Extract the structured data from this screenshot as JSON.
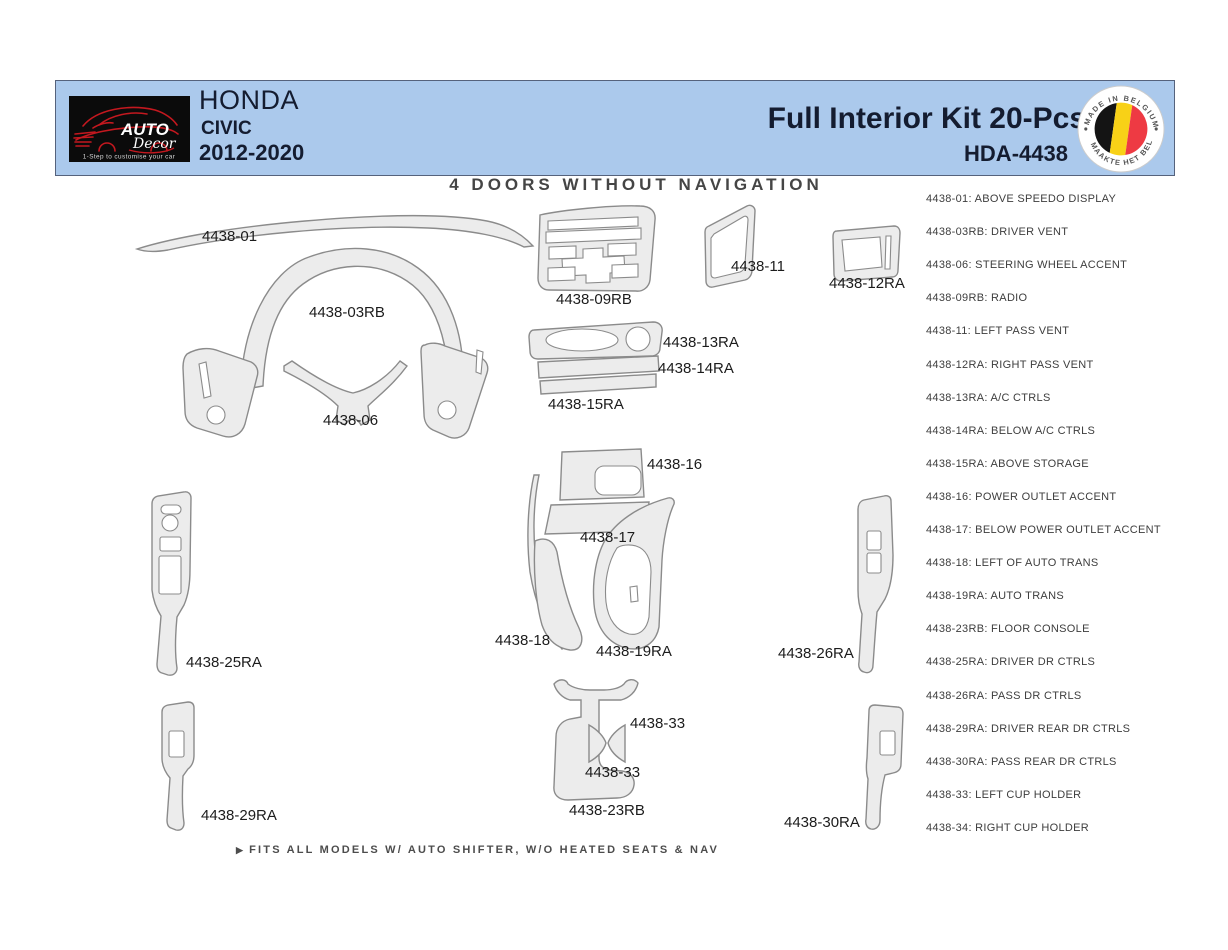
{
  "header": {
    "logo": {
      "brand_top": "AUTO",
      "brand_script": "Decor",
      "tagline": "1-Step to customise your car"
    },
    "vehicle": {
      "make": "HONDA",
      "model": "CIVIC",
      "years": "2012-2020"
    },
    "kit_title": "Full Interior Kit 20-Pcs.",
    "kit_code": "HDA-4438",
    "badge": {
      "arc_top": "MADE IN BELGIUM",
      "arc_bottom": "MAAKTE HET BELGIË"
    },
    "colors": {
      "band_bg": "#abc9ec",
      "band_border": "#55627c",
      "logo_red": "#c4181f",
      "flag_black": "#141414",
      "flag_yellow": "#f8d117",
      "flag_red": "#ee3a43"
    }
  },
  "diagram": {
    "title": "4 DOORS WITHOUT NAVIGATION",
    "footnote_marker": "▶",
    "footnote": "FITS ALL MODELS W/ AUTO SHIFTER, W/O HEATED SEATS & NAV",
    "colors": {
      "part_fill": "#ececec",
      "part_stroke": "#8b8b8b",
      "label_text": "#1c1c1c"
    },
    "part_labels": [
      {
        "text": "4438-01",
        "x": 202,
        "y": 228
      },
      {
        "text": "4438-03RB",
        "x": 309,
        "y": 304
      },
      {
        "text": "4438-06",
        "x": 323,
        "y": 412
      },
      {
        "text": "4438-09RB",
        "x": 556,
        "y": 291
      },
      {
        "text": "4438-11",
        "x": 731,
        "y": 258
      },
      {
        "text": "4438-12RA",
        "x": 829,
        "y": 275
      },
      {
        "text": "4438-13RA",
        "x": 663,
        "y": 334
      },
      {
        "text": "4438-14RA",
        "x": 658,
        "y": 360
      },
      {
        "text": "4438-15RA",
        "x": 548,
        "y": 396
      },
      {
        "text": "4438-16",
        "x": 647,
        "y": 456
      },
      {
        "text": "4438-17",
        "x": 580,
        "y": 529
      },
      {
        "text": "4438-18",
        "x": 495,
        "y": 632
      },
      {
        "text": "4438-19RA",
        "x": 596,
        "y": 643
      },
      {
        "text": "4438-25RA",
        "x": 186,
        "y": 654
      },
      {
        "text": "4438-26RA",
        "x": 778,
        "y": 645
      },
      {
        "text": "4438-33",
        "x": 630,
        "y": 715
      },
      {
        "text": "4438-33",
        "x": 585,
        "y": 764
      },
      {
        "text": "4438-23RB",
        "x": 569,
        "y": 802
      },
      {
        "text": "4438-29RA",
        "x": 201,
        "y": 807
      },
      {
        "text": "4438-30RA",
        "x": 784,
        "y": 814
      }
    ]
  },
  "legend": {
    "items": [
      {
        "code": "4438-01",
        "desc": "ABOVE SPEEDO DISPLAY"
      },
      {
        "code": "4438-03RB",
        "desc": "DRIVER VENT"
      },
      {
        "code": "4438-06",
        "desc": "STEERING WHEEL ACCENT"
      },
      {
        "code": "4438-09RB",
        "desc": "RADIO"
      },
      {
        "code": "4438-11",
        "desc": "LEFT PASS VENT"
      },
      {
        "code": "4438-12RA",
        "desc": "RIGHT PASS VENT"
      },
      {
        "code": "4438-13RA",
        "desc": "A/C CTRLS"
      },
      {
        "code": "4438-14RA",
        "desc": "BELOW A/C CTRLS"
      },
      {
        "code": "4438-15RA",
        "desc": "ABOVE STORAGE"
      },
      {
        "code": "4438-16",
        "desc": "POWER OUTLET ACCENT"
      },
      {
        "code": "4438-17",
        "desc": "BELOW POWER OUTLET ACCENT"
      },
      {
        "code": "4438-18",
        "desc": "LEFT OF AUTO TRANS"
      },
      {
        "code": "4438-19RA",
        "desc": "AUTO TRANS"
      },
      {
        "code": "4438-23RB",
        "desc": "FLOOR CONSOLE"
      },
      {
        "code": "4438-25RA",
        "desc": "DRIVER DR CTRLS"
      },
      {
        "code": "4438-26RA",
        "desc": "PASS DR CTRLS"
      },
      {
        "code": "4438-29RA",
        "desc": "DRIVER REAR DR CTRLS"
      },
      {
        "code": "4438-30RA",
        "desc": "PASS REAR DR CTRLS"
      },
      {
        "code": "4438-33",
        "desc": "LEFT CUP HOLDER"
      },
      {
        "code": "4438-34",
        "desc": "RIGHT CUP HOLDER"
      }
    ]
  }
}
